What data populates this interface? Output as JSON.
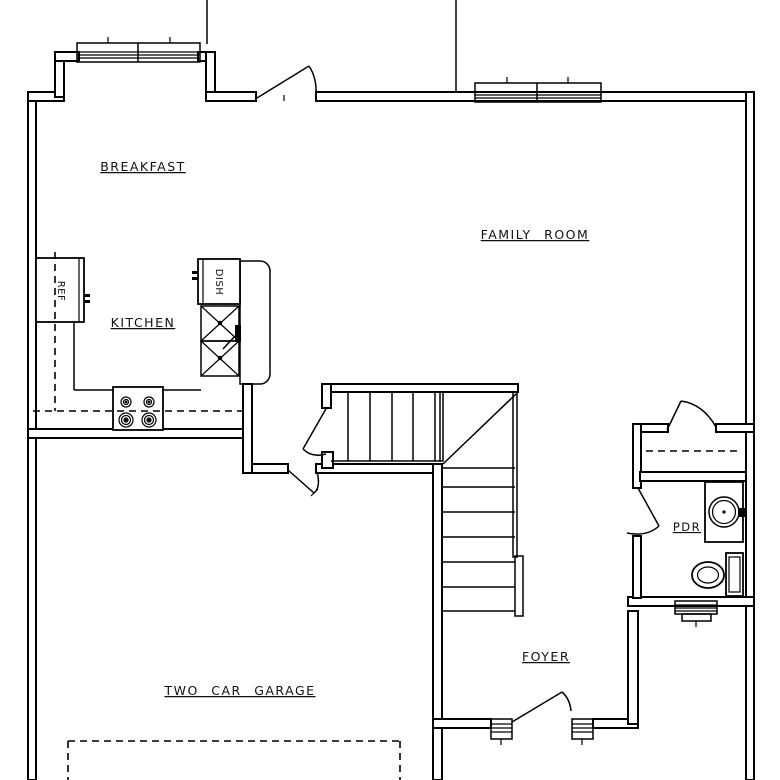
{
  "plan": {
    "rooms": {
      "breakfast": "BREAKFAST",
      "family_room": "FAMILY ROOM",
      "kitchen": "KITCHEN",
      "garage": "TWO CAR GARAGE",
      "foyer": "FOYER",
      "powder_room": "PDR"
    },
    "appliances": {
      "refrigerator": "REF",
      "dishwasher": "DISH"
    },
    "fixtures": [
      "bay-window",
      "family-room-window",
      "powder-room-window",
      "double-kitchen-sink",
      "range-cooktop",
      "refrigerator",
      "dishwasher",
      "l-shaped-staircase",
      "closet-rod",
      "pedestal-sink",
      "toilet",
      "front-door-with-sidelights",
      "garage-door-dashed-outline",
      "door-swings"
    ],
    "colors": {
      "line": "#000000",
      "background": "#ffffff"
    }
  }
}
